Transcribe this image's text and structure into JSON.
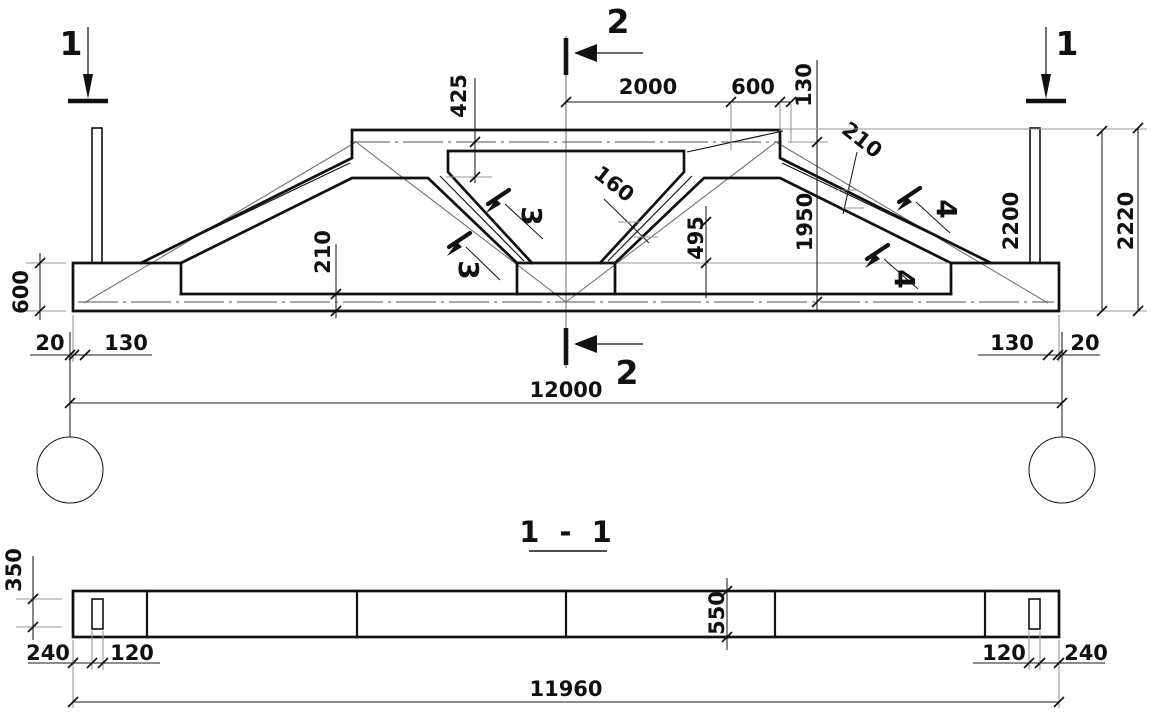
{
  "elevation": {
    "cut1": "1",
    "cut2": "2",
    "cut3": "3",
    "cut4": "4",
    "dim_2000": "2000",
    "dim_600_top": "600",
    "dim_130_top": "130",
    "dim_425": "425",
    "dim_160": "160",
    "dim_495": "495",
    "dim_1950": "1950",
    "dim_210_diag": "210",
    "dim_2200": "2200",
    "dim_2220": "2220",
    "dim_600_left": "600",
    "dim_210_chord": "210",
    "dim_20_left": "20",
    "dim_130_left": "130",
    "dim_130_right": "130",
    "dim_20_right": "20",
    "dim_span": "12000"
  },
  "plan": {
    "title": "1 - 1",
    "dim_350": "350",
    "dim_240_left": "240",
    "dim_120_left": "120",
    "dim_550": "550",
    "dim_120_right": "120",
    "dim_240_right": "240",
    "dim_length": "11960"
  }
}
